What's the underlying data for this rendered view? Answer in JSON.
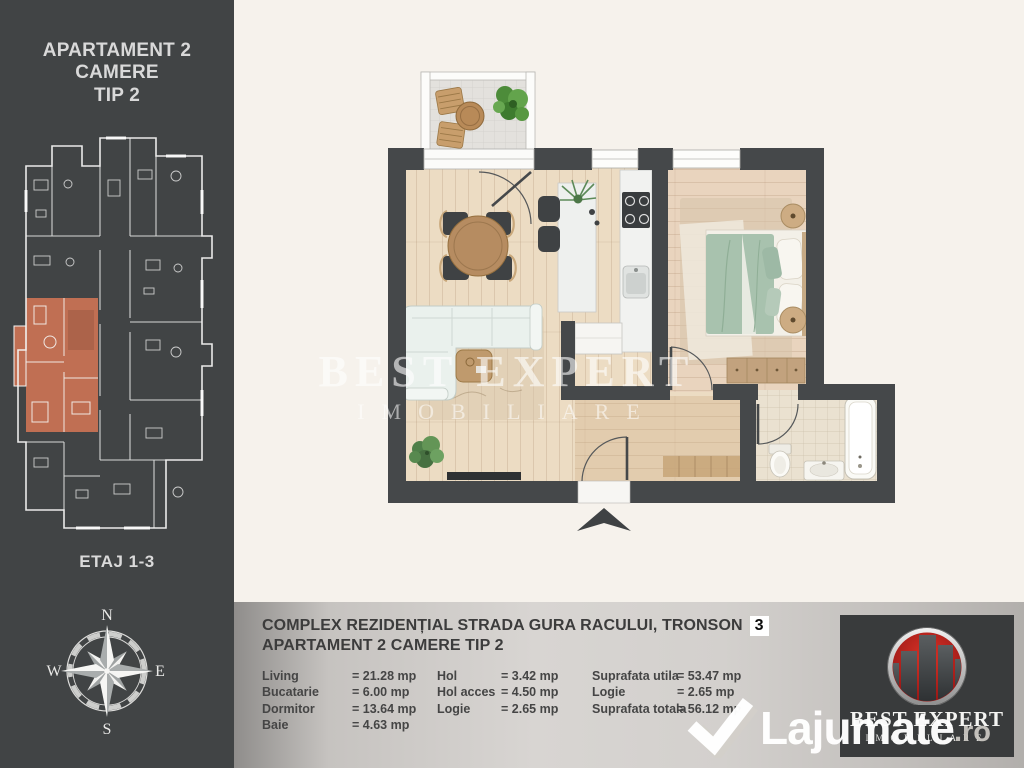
{
  "page": {
    "background": "#f6f2ec"
  },
  "sidebar": {
    "background": "#414445",
    "title_line1": "APARTAMENT 2 CAMERE",
    "title_line2": "TIP 2",
    "floor_label": "ETAJ 1-3",
    "highlighted_unit_color": "#c06f53",
    "compass": {
      "n": "N",
      "s": "S",
      "e": "E",
      "w": "W"
    }
  },
  "floorplan": {
    "wall_color": "#45484a",
    "watermark_line1": "BEST EXPERT",
    "watermark_line2": "IMOBILIARE"
  },
  "bottom_bar": {
    "title_line1": "COMPLEX REZIDENȚIAL STRADA GURA RACULUI, TRONSON",
    "tronson_badge": "3",
    "title_line2": "APARTAMENT 2 CAMERE TIP 2",
    "areas_col1": [
      {
        "label": "Living",
        "value": "= 21.28 mp"
      },
      {
        "label": "Bucatarie",
        "value": "= 6.00 mp"
      },
      {
        "label": "Dormitor",
        "value": "= 13.64 mp"
      },
      {
        "label": "Baie",
        "value": "=  4.63 mp"
      }
    ],
    "areas_col2": [
      {
        "label": "Hol",
        "value": "=  3.42 mp"
      },
      {
        "label": "Hol acces",
        "value": "= 4.50 mp"
      },
      {
        "label": "Logie",
        "value": "=  2.65 mp"
      }
    ],
    "areas_col3": [
      {
        "label": "Suprafata utila",
        "value": "= 53.47 mp"
      },
      {
        "label": "Logie",
        "value": "=  2.65 mp"
      },
      {
        "label": "Suprafata totala",
        "value": "= 56.12 mp"
      }
    ]
  },
  "logo": {
    "brand_line1": "BEST EXPERT",
    "brand_line2": "IMOBILIARE",
    "emblem_red": "#b01c1c"
  },
  "site_watermark": {
    "name": "Lajumate",
    "tld": ".ro"
  }
}
